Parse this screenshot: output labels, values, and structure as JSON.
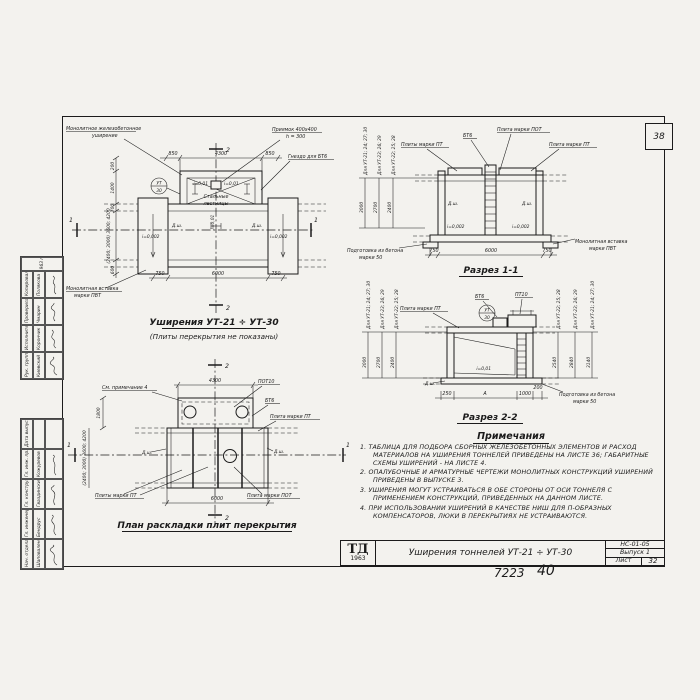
{
  "page": {
    "corner_number": "38",
    "footer_order": "7223",
    "footer_sheet": "40"
  },
  "plan_top": {
    "title": "Уширения УТ-21 ÷ УТ-30",
    "subtitle": "(Плиты перекрытия не показаны)",
    "labels": {
      "monolithic_1": "Монолитное железобетонное",
      "monolithic_2": "уширение",
      "pit_1": "Приямок 400х400",
      "pit_2": "h = 300",
      "socket": "Гнездо для БТ6",
      "insert_1": "Монолитная вставка",
      "insert_2": "марки ПВТ",
      "ladders_1": "Стальные",
      "ladders_2": "лестницы",
      "slope_left": "i=0,002",
      "slope_right": "i=0,002",
      "slope_top_left": "i=0,01",
      "slope_top_right": "i=0,01",
      "slope_center": "i=0,01",
      "joint_left": "Д.ш.",
      "joint_right": "Д.ш.",
      "mark_circle_top": "УТ",
      "mark_circle_bottom": "30",
      "section_mark_2": "2",
      "section_mark_1": "1"
    },
    "dims": {
      "top": [
        "850",
        "4300",
        "850"
      ],
      "bottom": [
        "750",
        "6000",
        "750"
      ],
      "left": [
        "200",
        "1400",
        "700",
        "600"
      ],
      "left_rotated": "(2400; 3000) 3600; 4200"
    }
  },
  "section1": {
    "title": "Разрез 1-1",
    "labels": {
      "bt6": "БТ6",
      "pot": "Плита марки ПОТ",
      "pt_plural": "Плиты марки ПТ",
      "pt": "Плита марки ПТ",
      "insert_1": "Монолитная вставка",
      "insert_2": "марки ПВТ",
      "base_1": "Подготовка из бетона",
      "base_2": "марки 50",
      "joint_left": "Д.ш.",
      "joint_right": "Д.ш.",
      "slope_left": "i=0,002",
      "slope_right": "i=0,002"
    },
    "left_columns": {
      "labels": [
        "Для УТ-21; 24; 27; 30",
        "Для УТ-23; 26; 29",
        "Для УТ-22; 25; 28"
      ],
      "heights": [
        "3000",
        "2700",
        "2400"
      ]
    },
    "dims_bottom": [
      "750",
      "6000",
      "750"
    ]
  },
  "section2": {
    "title": "Разрез 2-2",
    "labels": {
      "pt": "Плита марки ПТ",
      "bt6": "БТ6",
      "pt10": "ПТ10",
      "slope": "i=0,01",
      "base_1": "Подготовка из бетона",
      "base_2": "марки 50",
      "joint": "Д.ш.",
      "mark_circle_top": "УТ",
      "mark_circle_bottom": "30"
    },
    "left_columns": {
      "labels": [
        "Для УТ-21; 24; 27; 30",
        "Для УТ-23; 26; 29",
        "Для УТ-22; 25; 28"
      ],
      "heights": [
        "3000",
        "2700",
        "2400"
      ]
    },
    "right_columns": {
      "labels": [
        "Для УТ-22; 25; 28",
        "Для УТ-23; 26; 29",
        "Для УТ-21; 24; 27; 30"
      ],
      "heights": [
        "2540",
        "2840",
        "3140"
      ]
    },
    "dims_bottom": [
      "250",
      "А",
      "1000",
      "200"
    ]
  },
  "plan_bottom": {
    "title": "План раскладки плит перекрытия",
    "labels": {
      "note_ref": "См. примечание 4",
      "pot10": "ПОТ10",
      "bt6": "БТ6",
      "pt": "Плита марки ПТ",
      "pt_plural": "Плиты марки ПТ",
      "pot": "Плита марки ПОТ",
      "joint_left": "Д.ш.",
      "joint_right": "Д.ш.",
      "section_mark_2": "2",
      "section_mark_1": "1"
    },
    "dims": {
      "top": "4300",
      "bottom": "6000",
      "left_top": "1800",
      "left_rotated": "(2400; 3000) 3600; 4200"
    }
  },
  "notes": {
    "title": "Примечания",
    "items": [
      {
        "num": "1.",
        "text": "Таблица для подбора сборных железобетонных элементов и расход материалов на уширения тоннелей приведены на листе 36; габаритные схемы уширений - на листе 4."
      },
      {
        "num": "2.",
        "text": "Опалубочные и арматурные чертежи монолитных конструкций уширений приведены в выпуске 3."
      },
      {
        "num": "3.",
        "text": "Уширения могут устраиваться в обе стороны от оси тоннеля с применением конструкций, приведенных на данном листе."
      },
      {
        "num": "4.",
        "text": "При использовании уширений в качестве ниш для П-образных компенсаторов, люки в перекрытиях не устраиваются."
      }
    ]
  },
  "titleblock": {
    "logo_top": "ТД",
    "logo_year": "1963",
    "title": "Уширения тоннелей УТ-21 ÷ УТ-30",
    "code": "НС-01-05",
    "issue": "Выпуск 1",
    "sheet_label": "Лист",
    "sheet_number": "32"
  },
  "stamp_top": {
    "year": "1963 г.",
    "rows": [
      {
        "role": "Рук. группы",
        "name": "Киевский"
      },
      {
        "role": "Исполнитель",
        "name": "Корончик"
      },
      {
        "role": "Проверила",
        "name": "Чмарин"
      },
      {
        "role": "Копировала",
        "name": "Полякова"
      }
    ]
  },
  "stamp_bottom": {
    "rows": [
      {
        "role": "Нач. отдела",
        "name": "Шаповаленский"
      },
      {
        "role": "Гл. инженер",
        "name": "Бендрус"
      },
      {
        "role": "Гл. конструктор",
        "name": "Гваздинский"
      },
      {
        "role": "Гл. инж. пр.",
        "name": "Кожуревов"
      },
      {
        "role": "Дата выпуска",
        "name": ""
      }
    ]
  }
}
